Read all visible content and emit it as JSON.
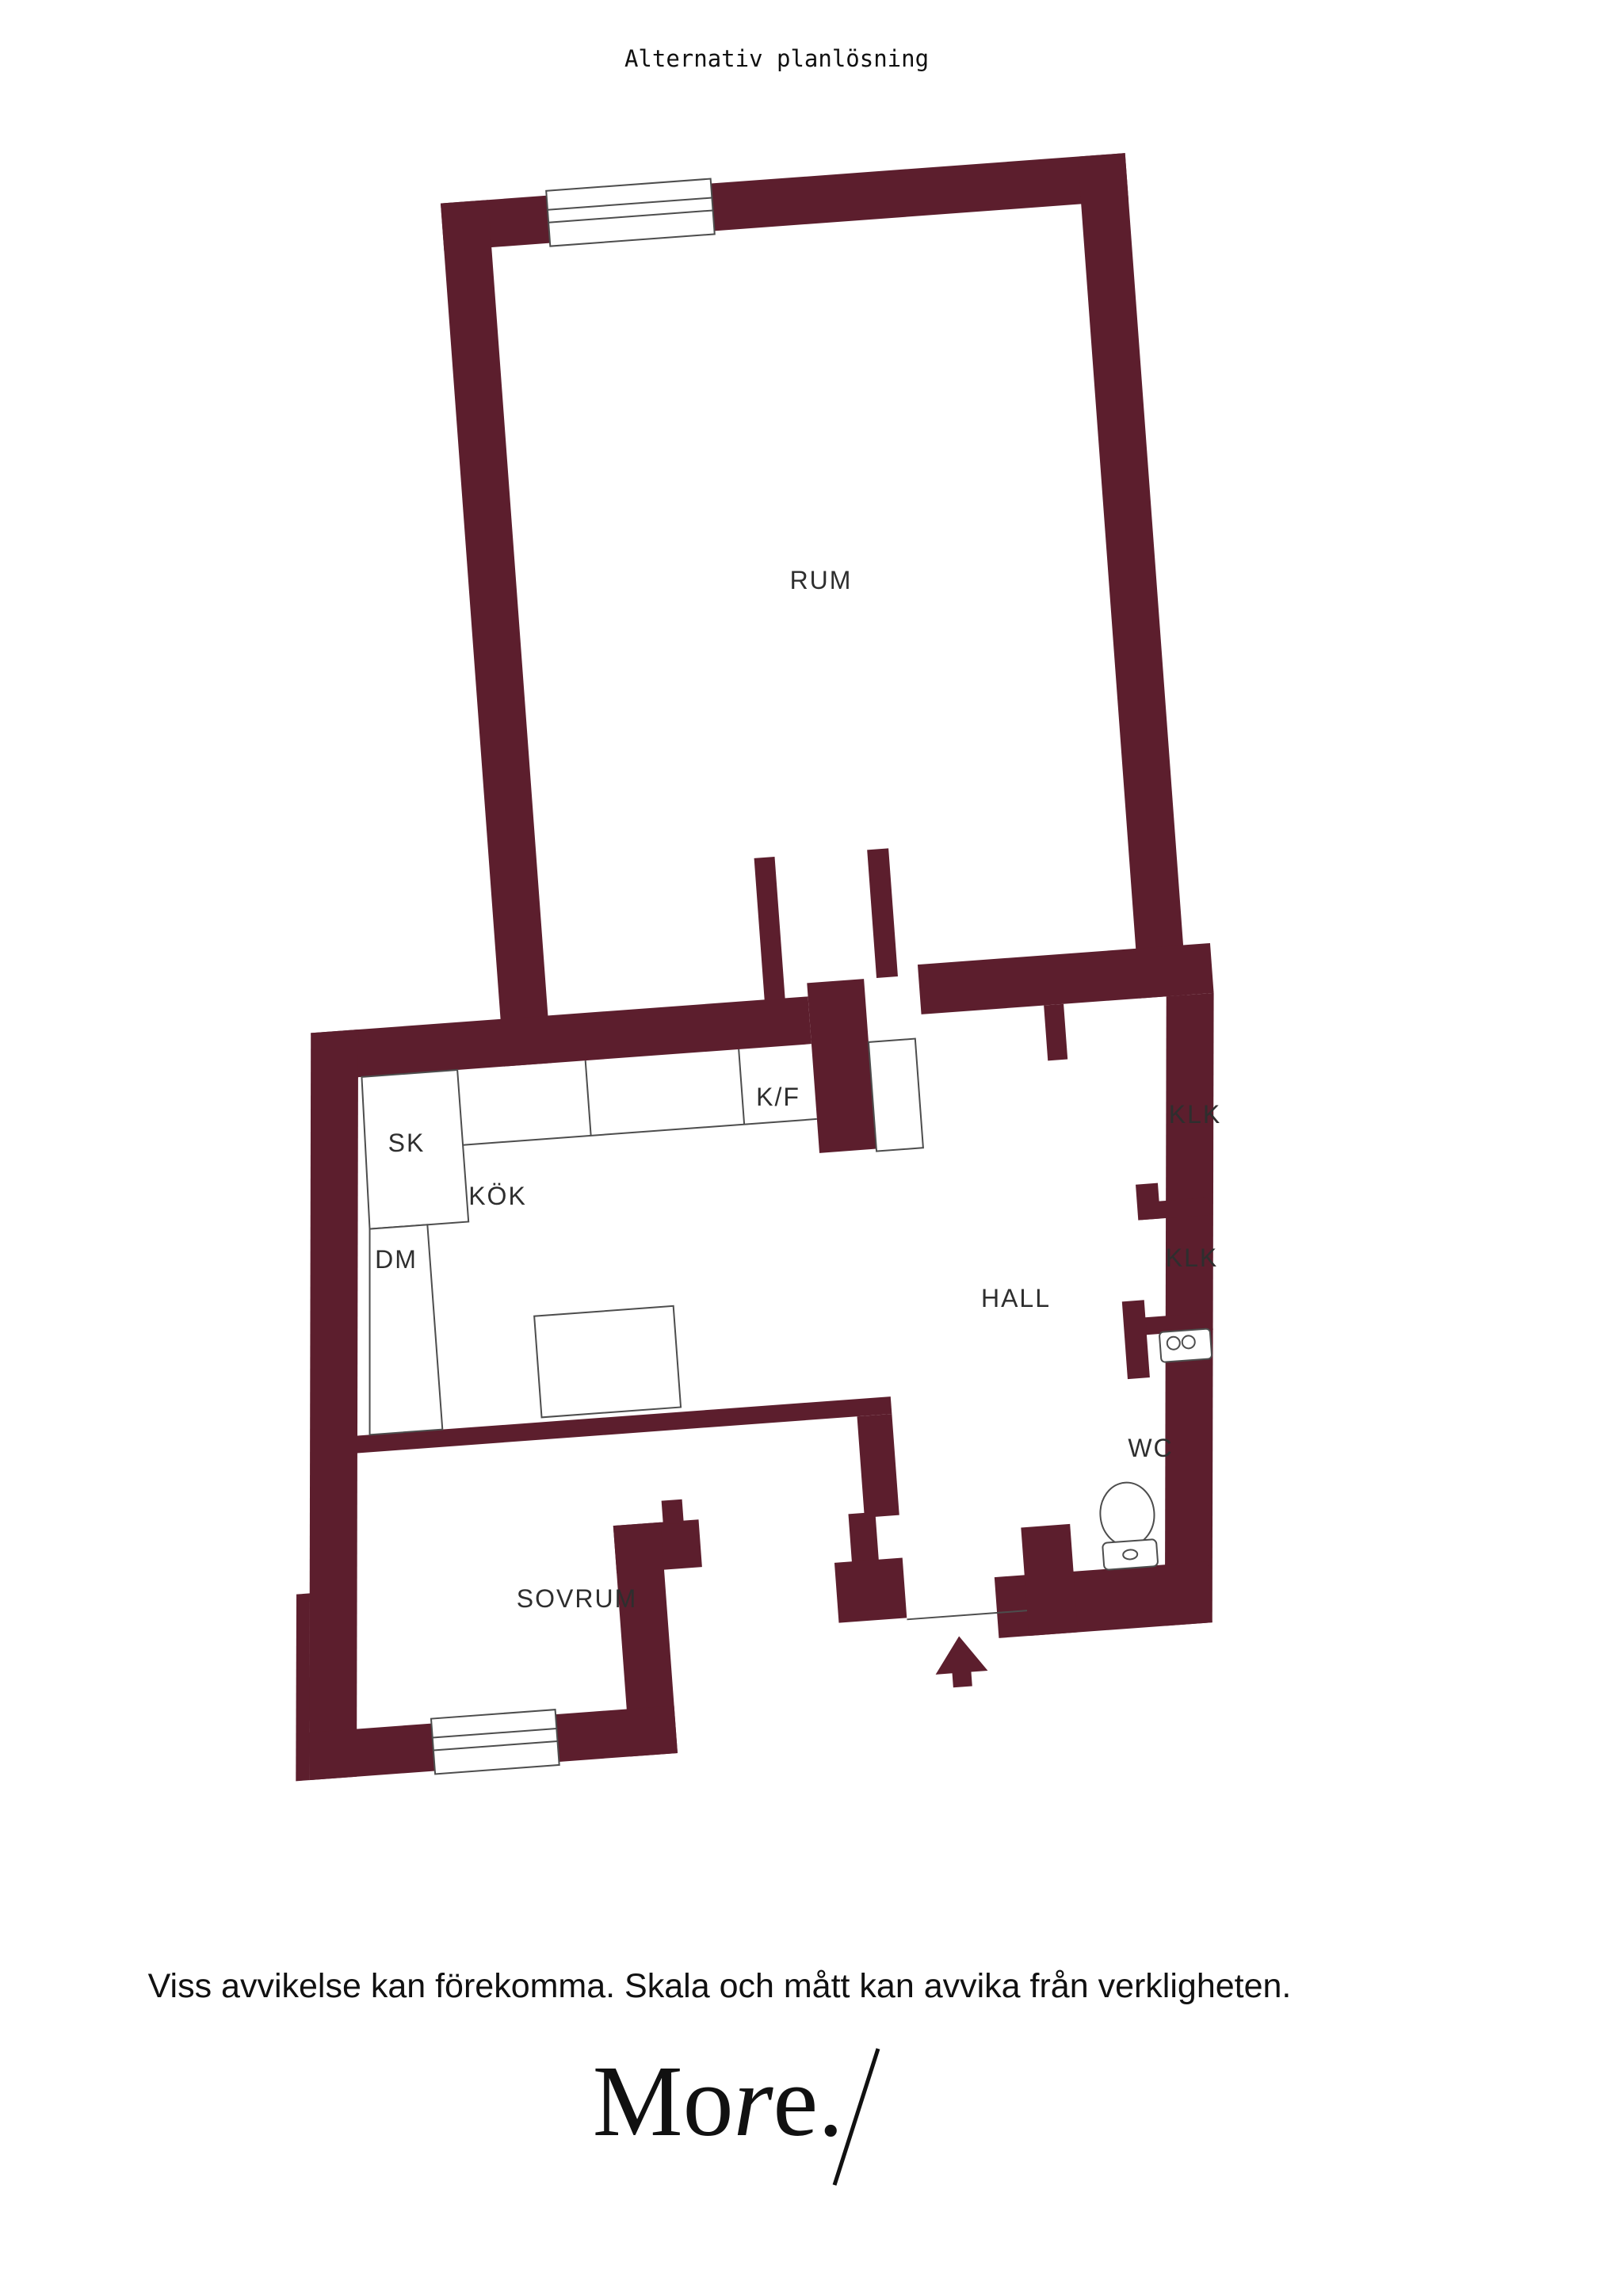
{
  "title": "Alternativ planlösning",
  "floorplan": {
    "rooms": {
      "rum": "RUM",
      "kok": "KÖK",
      "sovrum": "SOVRUM",
      "hall": "HALL",
      "wc": "WC",
      "klk_upper": "KLK",
      "klk_lower": "KLK",
      "sk": "SK",
      "dm": "DM",
      "kf": "K/F"
    },
    "colors": {
      "wall": "#5C1E2D",
      "line": "#4D4D4D",
      "label": "#2E2E2E"
    },
    "icons": {
      "entrance": "entrance-arrow-icon",
      "toilet": "toilet-icon",
      "sink": "sink-icon",
      "windows": "window-symbol"
    }
  },
  "footer": {
    "disclaimer": "Viss avvikelse kan förekomma. Skala och mått kan avvika från verkligheten."
  },
  "logo": {
    "mo": "Mo",
    "r": "r",
    "e": "e.",
    "slash": "/"
  }
}
